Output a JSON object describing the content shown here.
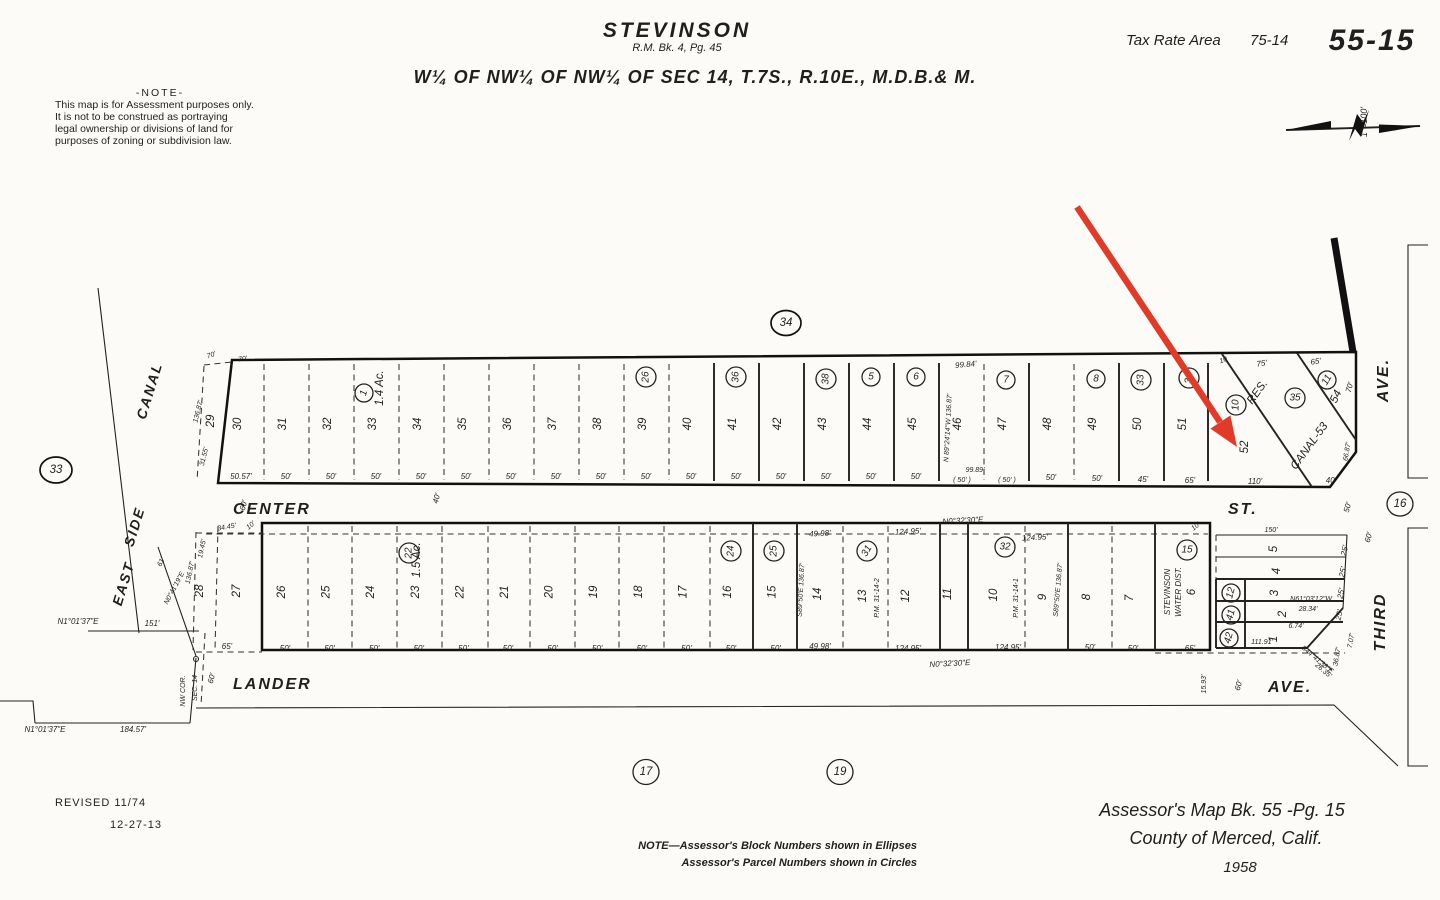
{
  "header": {
    "note_title": "-NOTE-",
    "note_lines": [
      "This map is for Assessment purposes only.",
      "It is not to be construed as portraying",
      "legal ownership or divisions of land for",
      "purposes of zoning or subdivision law."
    ],
    "title": "STEVINSON",
    "subtitle": "R.M. Bk. 4, Pg. 45",
    "legal": "W¼ OF NW¼ OF NW¼ OF SEC 14, T.7S., R.10E., M.D.B.& M.",
    "tax_rate_area_label": "Tax Rate Area",
    "tax_rate_area_value": "75-14",
    "sheet_number": "55-15",
    "scale_label": "1\"=100'"
  },
  "streets": {
    "center": "CENTER",
    "center_suffix": "ST.",
    "lander": "LANDER",
    "lander_suffix": "AVE.",
    "third": "THIRD",
    "third_suffix": "AVE.",
    "canal_words": [
      "EAST",
      "SIDE",
      "CANAL"
    ],
    "res": "RES.",
    "canal_parcel": "CANAL-53"
  },
  "block_ellipses": {
    "west": "33",
    "north": "34",
    "east": "16",
    "south_a": "17",
    "south_b": "19"
  },
  "upper": {
    "lot_29": "29",
    "lot_52": "52",
    "lot_54": "54",
    "lots": [
      "30",
      "31",
      "32",
      "33",
      "34",
      "35",
      "36",
      "37",
      "38",
      "39",
      "40",
      "41",
      "42",
      "43",
      "44",
      "45",
      "46",
      "47",
      "48",
      "49",
      "50",
      "51"
    ],
    "acreage": "1.4 Ac.",
    "acreage_circle": "1",
    "circles": {
      "c26": "26",
      "c36": "36",
      "c38": "38",
      "c5": "5",
      "c6": "6",
      "c7": "7",
      "c8": "8",
      "c33": "33",
      "c34": "34",
      "c10": "10",
      "c35": "35",
      "c11": "11"
    },
    "top_dims": {
      "d70a": "70'",
      "d70b": "70'",
      "d9984": "99.84'",
      "d10": "10",
      "d75": "75'",
      "d65": "65'",
      "d70c": "70'"
    },
    "left_dims": {
      "d13687": "136.87'",
      "d3155": "31.55'"
    },
    "bottom_dims_run": [
      "50.57'",
      "50'",
      "50'",
      "50'",
      "50'",
      "50'",
      "50'",
      "50'",
      "50'",
      "50'",
      "50'",
      "50'",
      "50'",
      "50'",
      "50'",
      "50'"
    ],
    "bottom_right": {
      "d9989": "99.89'",
      "paren_a": "( 50' )",
      "paren_b": "( 50' )",
      "d50a": "50'",
      "d50b": "50'",
      "d45": "45'",
      "d65": "65'",
      "d110": "110'",
      "d40": "40'",
      "d6687": "66.87'"
    },
    "bearing_46": "N 89°24'14\"W  136.87'"
  },
  "lower": {
    "lot_28": "28",
    "lot_27": "27",
    "lots_run": [
      "26",
      "25",
      "24",
      "23",
      "22",
      "21",
      "20",
      "19",
      "18",
      "17",
      "16",
      "15"
    ],
    "lots_right": {
      "l14": "14",
      "l13": "13",
      "l12": "12",
      "l11": "11",
      "l10": "10",
      "l9": "9",
      "l8": "8",
      "l7": "7",
      "l6": "6"
    },
    "strip_lots": {
      "s5": "5",
      "s4": "4",
      "s3": "3",
      "s2": "2",
      "s1": "1"
    },
    "acreage": "1.5 Ac.",
    "circles": {
      "c22": "22",
      "c24": "24",
      "c25": "25",
      "c31": "31",
      "c32": "32",
      "c15": "15",
      "c12": "12",
      "c41": "41",
      "c42": "42"
    },
    "water_district": [
      "STEVINSON",
      "WATER DIST."
    ],
    "pm_a": "P.M. 31-14-2",
    "pm_b": "P.M. 31-14-1",
    "dims": {
      "top_10a": "10'",
      "top_10b": "10'",
      "top_4998": "49.98'",
      "top_12495a": "124.95'",
      "top_12495b": "124.95'",
      "bearing_top": "N0°32'30\"E",
      "bearing_bottom": "N0°32'30\"E",
      "bot_65a": "65'",
      "bottom_run": [
        "50'",
        "50'",
        "50'",
        "50'",
        "50'",
        "50'",
        "50'",
        "50'",
        "50'",
        "50'",
        "50'",
        "50'"
      ],
      "bot_4998": "49.98'",
      "bot_12495a": "124.95'",
      "bot_12495b": "124.95'",
      "bot_50a": "50'",
      "bot_50b": "50'",
      "bot_65b": "65'",
      "d3445": "34.45'",
      "d1945": "19.45'",
      "d13687": "136.87'",
      "edge_a": "S89°50'E  136.87'",
      "edge_b": "S89°50'E  136.87'",
      "strip_150": "150'",
      "strip_25": [
        "25'",
        "25'",
        "25'",
        "25'"
      ],
      "br_n61": "N61°03'12\"W",
      "br_n61_len": "28.34'",
      "d674": "6.74'",
      "d11191": "111.91'",
      "d3687": "36.87'",
      "d707": "7.07'",
      "br_s44": "S44°41'38\"E",
      "br_s44_len": "26.35'",
      "d1593": "15.93'",
      "d60_lander_l": "60'",
      "d60_lander_r": "60'",
      "d60_center": "60'",
      "d40_center": "40'",
      "d50_st": "50'",
      "d60_third": "60'"
    }
  },
  "west": {
    "br_151": "N1°01'37\"E",
    "d151": "151'",
    "br_184": "N1°01'37\"E",
    "d18457": "184.57'",
    "nw_cor": [
      "NW COR.",
      "SEC. 14"
    ],
    "br_canal": "N0°41'19\"E",
    "d61": "61'"
  },
  "footer": {
    "revised": "REVISED 11/74",
    "revised2": "12-27-13",
    "note1": "NOTE—Assessor's Block Numbers shown in Ellipses",
    "note2": "Assessor's Parcel Numbers shown in Circles",
    "credit1": "Assessor's Map Bk. 55 -Pg. 15",
    "credit2": "County of Merced, Calif.",
    "credit3": "1958"
  },
  "colors": {
    "ink": "#1f1f1f",
    "paper": "#fcfbf7",
    "arrow": "#e03b28"
  }
}
